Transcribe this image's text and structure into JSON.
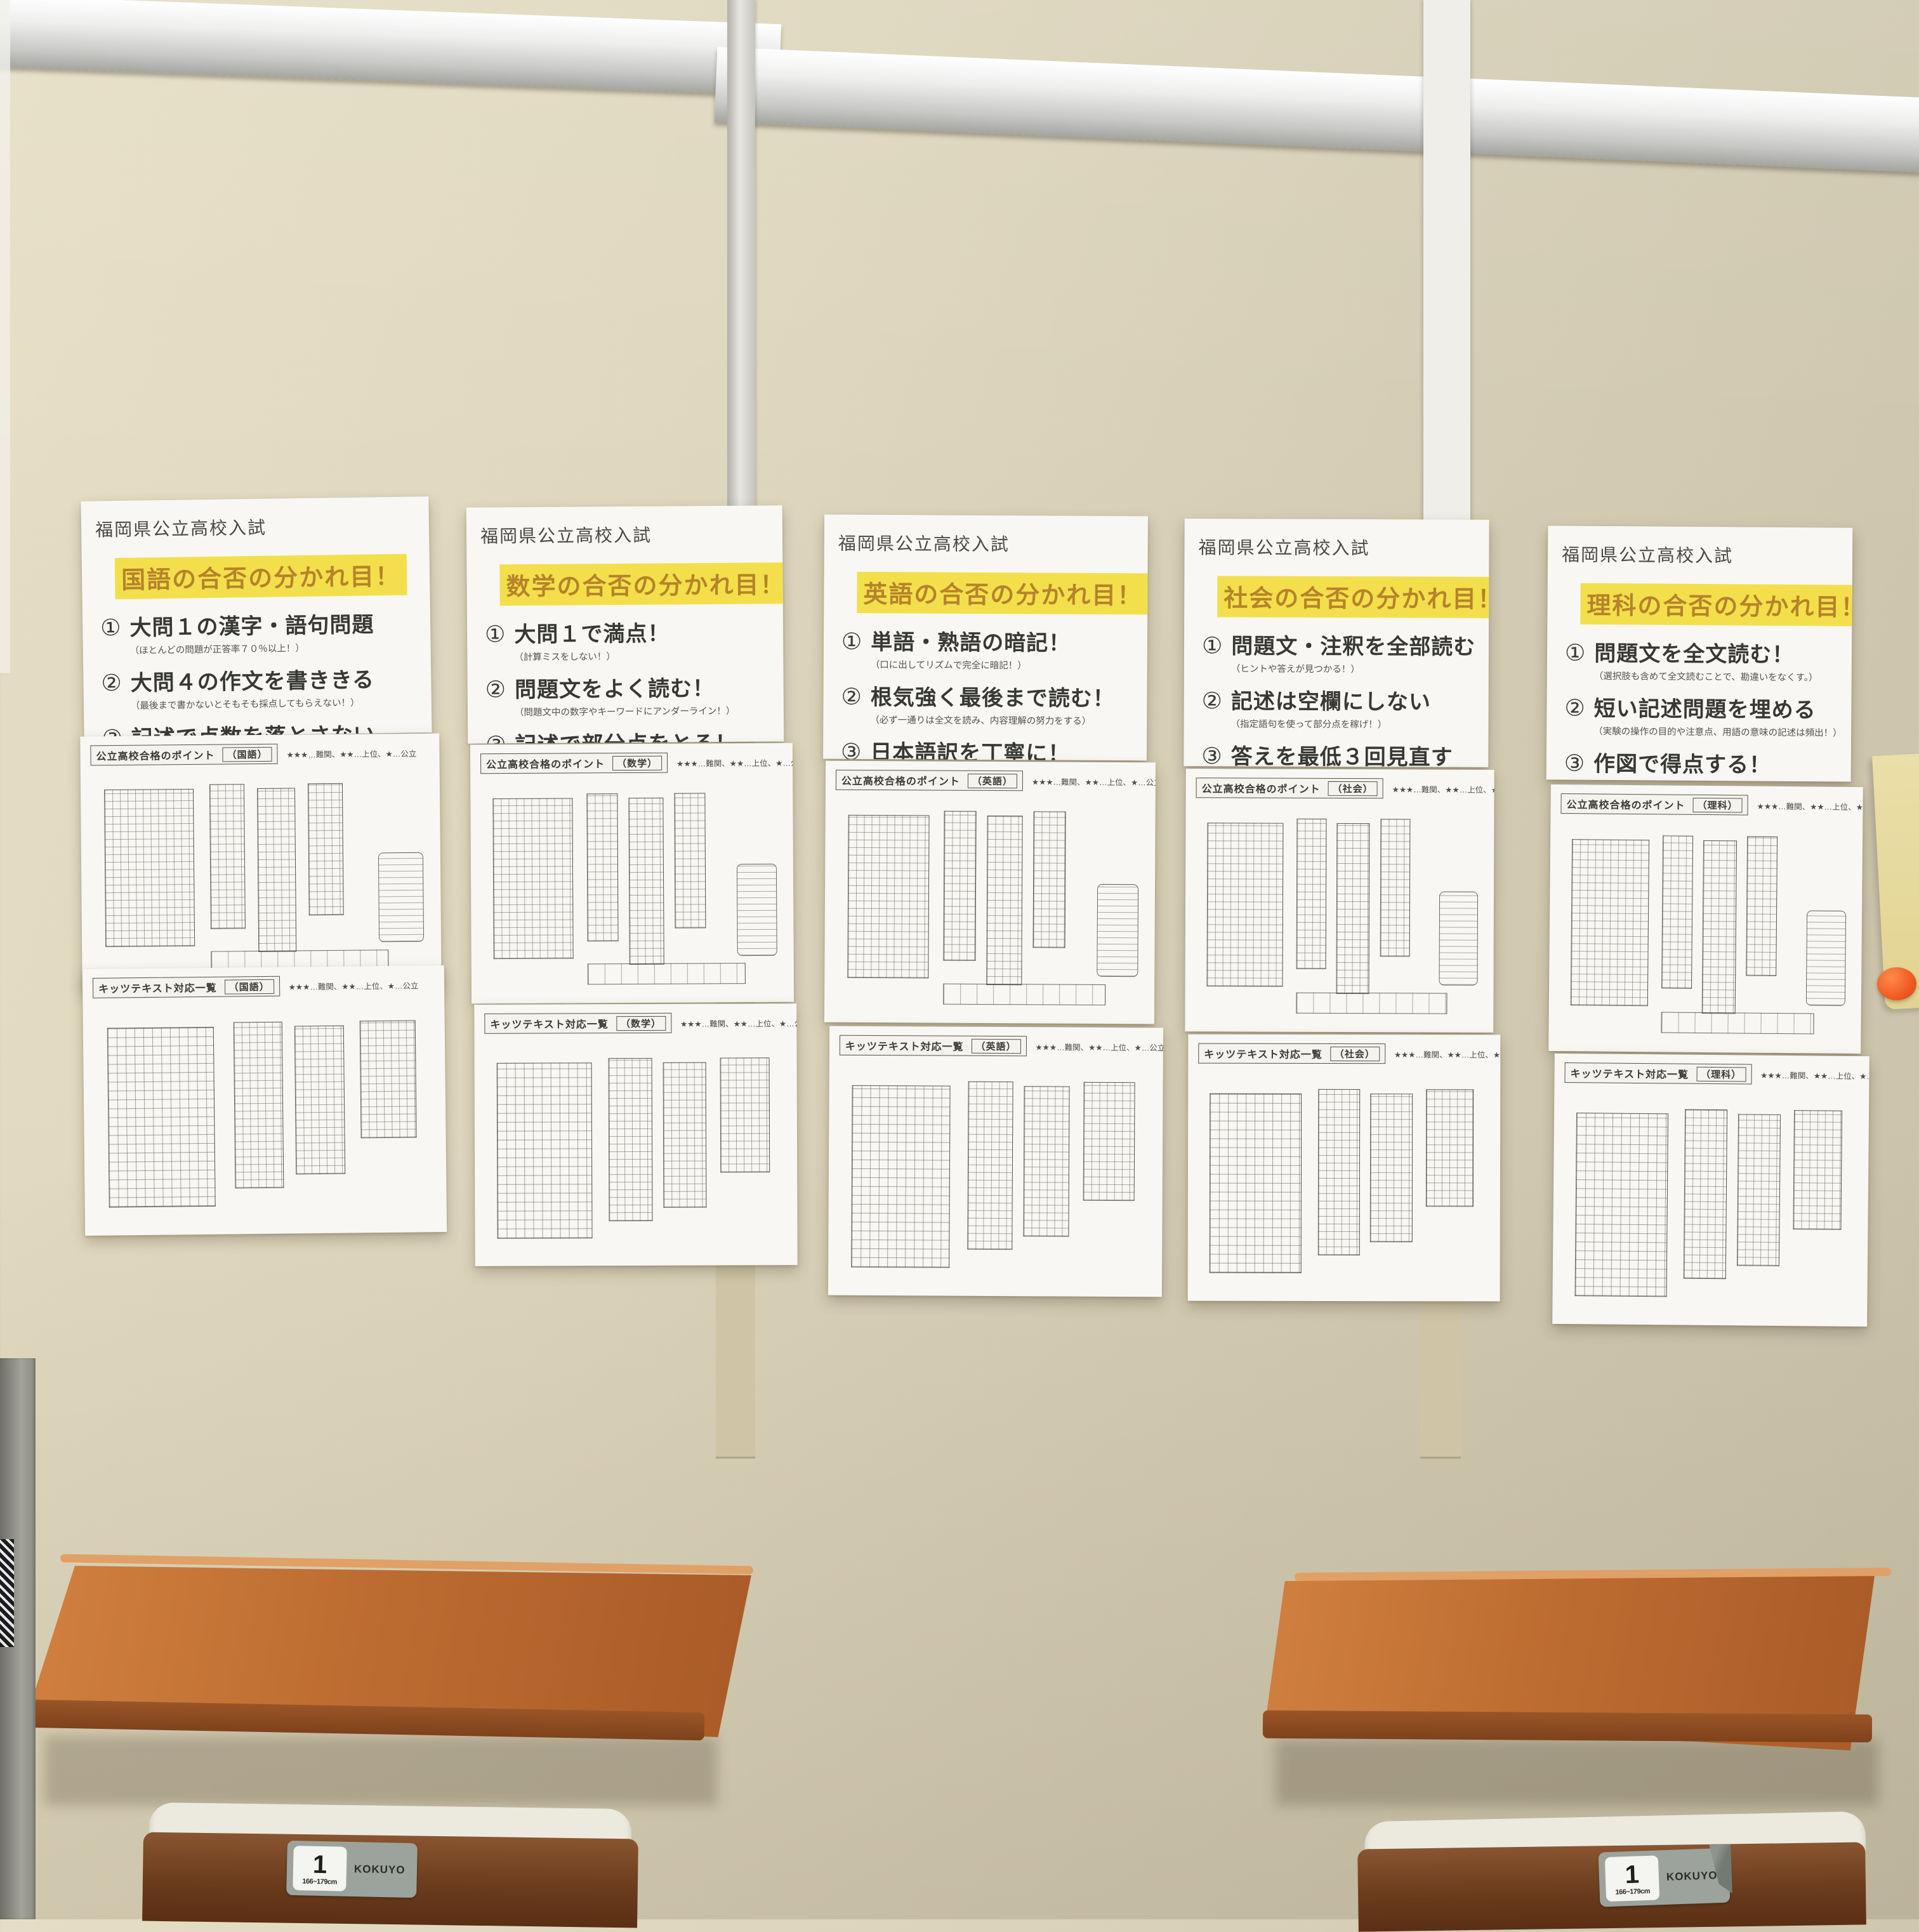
{
  "posters": [
    {
      "title": "福岡県公立高校入試",
      "subject_line": "国語の合否の分かれ目！",
      "items": [
        {
          "num": "①",
          "text": "大問１の漢字・語句問題",
          "note": "（ほとんどの問題が正答率７０％以上！）"
        },
        {
          "num": "②",
          "text": "大問４の作文を書ききる",
          "note": "（最後まで書かないとそもそも採点してもらえない！）"
        },
        {
          "num": "③",
          "text": "記述で点数を落とさない",
          "note": "（配点の数だけキーワードを入れる！）"
        }
      ]
    },
    {
      "title": "福岡県公立高校入試",
      "subject_line": "数学の合否の分かれ目！",
      "items": [
        {
          "num": "①",
          "text": "大問１で満点！",
          "note": "（計算ミスをしない！）"
        },
        {
          "num": "②",
          "text": "問題文をよく読む！",
          "note": "（問題文中の数字やキーワードにアンダーライン！）"
        },
        {
          "num": "③",
          "text": "記述で部分点をとる！",
          "note": "（採点基準のポイントを押さえる！）"
        }
      ]
    },
    {
      "title": "福岡県公立高校入試",
      "subject_line": "英語の合否の分かれ目！",
      "items": [
        {
          "num": "①",
          "text": "単語・熟語の暗記！",
          "note": "（口に出してリズムで完全に暗記！）"
        },
        {
          "num": "②",
          "text": "根気強く最後まで読む！",
          "note": "（必ず一通りは全文を読み、内容理解の努力をする）"
        },
        {
          "num": "③",
          "text": "日本語訳を丁寧に！",
          "note": "（一文の日本語訳が答えになるため、余計な言葉をもってこない）"
        }
      ]
    },
    {
      "title": "福岡県公立高校入試",
      "subject_line": "社会の合否の分かれ目！",
      "items": [
        {
          "num": "①",
          "text": "問題文・注釈を全部読む",
          "note": "（ヒントや答えが見つかる！）"
        },
        {
          "num": "②",
          "text": "記述は空欄にしない",
          "note": "（指定語句を使って部分点を稼げ！）"
        },
        {
          "num": "③",
          "text": "答えを最低３回見直す",
          "note": "（誤字・脱字の確認をする、自信がなければひらがなで！）"
        }
      ]
    },
    {
      "title": "福岡県公立高校入試",
      "subject_line": "理科の合否の分かれ目！",
      "items": [
        {
          "num": "①",
          "text": "問題文を全文読む！",
          "note": "（選択肢も含めて全文読むことで、勘違いをなくす。）"
        },
        {
          "num": "②",
          "text": "短い記述問題を埋める",
          "note": "（実験の操作の目的や注意点、用語の意味の記述は頻出！）"
        },
        {
          "num": "③",
          "text": "作図で得点する！",
          "note": "（実は簡単な問題が多い！ここで正解できるかがポイント！）"
        }
      ]
    }
  ],
  "sheets": [
    {
      "title": "公立高校合格のポイント",
      "subject": "（国語）",
      "legend": "★★★…難関、★★…上位、★…公立"
    },
    {
      "title": "キッツテキスト対応一覧",
      "subject": "（国語）",
      "legend": "★★★…難関、★★…上位、★…公立"
    },
    {
      "title": "公立高校合格のポイント",
      "subject": "（数学）",
      "legend": "★★★…難関、★★…上位、★…公立"
    },
    {
      "title": "キッツテキスト対応一覧",
      "subject": "（数学）",
      "legend": "★★★…難関、★★…上位、★…公立"
    },
    {
      "title": "公立高校合格のポイント",
      "subject": "（英語）",
      "legend": "★★★…難関、★★…上位、★…公立"
    },
    {
      "title": "キッツテキスト対応一覧",
      "subject": "（英語）",
      "legend": "★★★…難関、★★…上位、★…公立"
    },
    {
      "title": "公立高校合格のポイント",
      "subject": "（社会）",
      "legend": "★★★…難関、★★…上位、★…公立"
    },
    {
      "title": "キッツテキスト対応一覧",
      "subject": "（社会）",
      "legend": "★★★…難関、★★…上位、★…公立"
    },
    {
      "title": "公立高校合格のポイント",
      "subject": "（理科）",
      "legend": "★★★…難関、★★…上位、★…公立"
    },
    {
      "title": "キッツテキスト対応一覧",
      "subject": "（理科）",
      "legend": "★★★…難関、★★…上位、★…公立"
    }
  ],
  "furniture": {
    "chair_label_number": "1",
    "chair_label_size": "166~179cm",
    "chair_brand": "KOKUYO"
  },
  "colors": {
    "wall": "#d9d1b8",
    "highlight_yellow": "#f3df4b",
    "subject_text_orange": "#b5832a",
    "desk_wood": "#bd6c31",
    "chair_wood": "#6b3c1d",
    "rail_silver": "#d9d9d7",
    "label_gray": "#9ba39c",
    "magnet_orange": "#ef5c22"
  }
}
